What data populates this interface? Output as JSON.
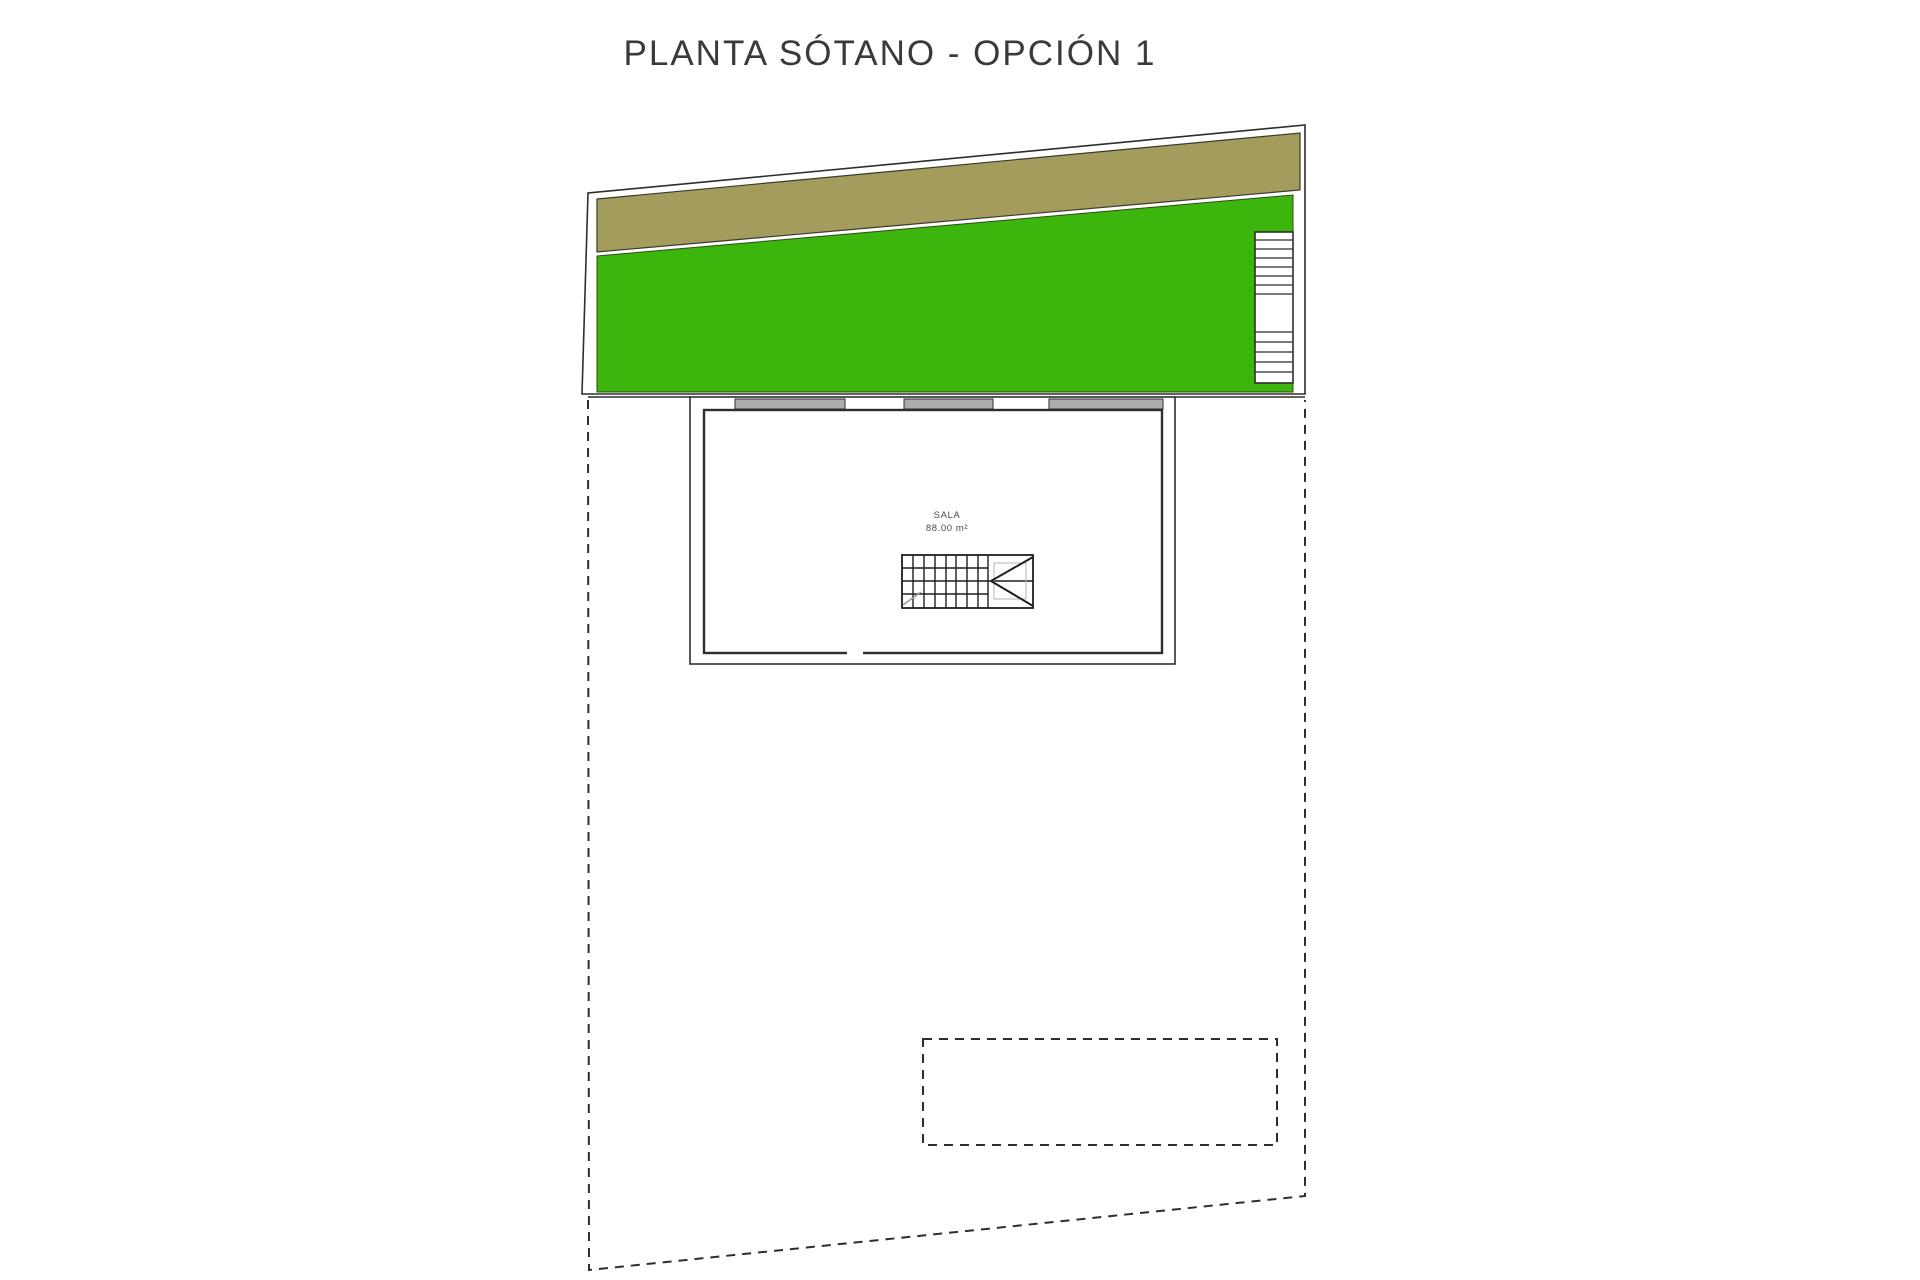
{
  "title": "PLANTA SÓTANO - OPCIÓN 1",
  "room": {
    "name": "SALA",
    "area": "88.00 m²"
  },
  "colors": {
    "grass": "#3CB50D",
    "soil": "#A49C5C",
    "window": "#ADADAD",
    "line": "#2E2E2E"
  }
}
